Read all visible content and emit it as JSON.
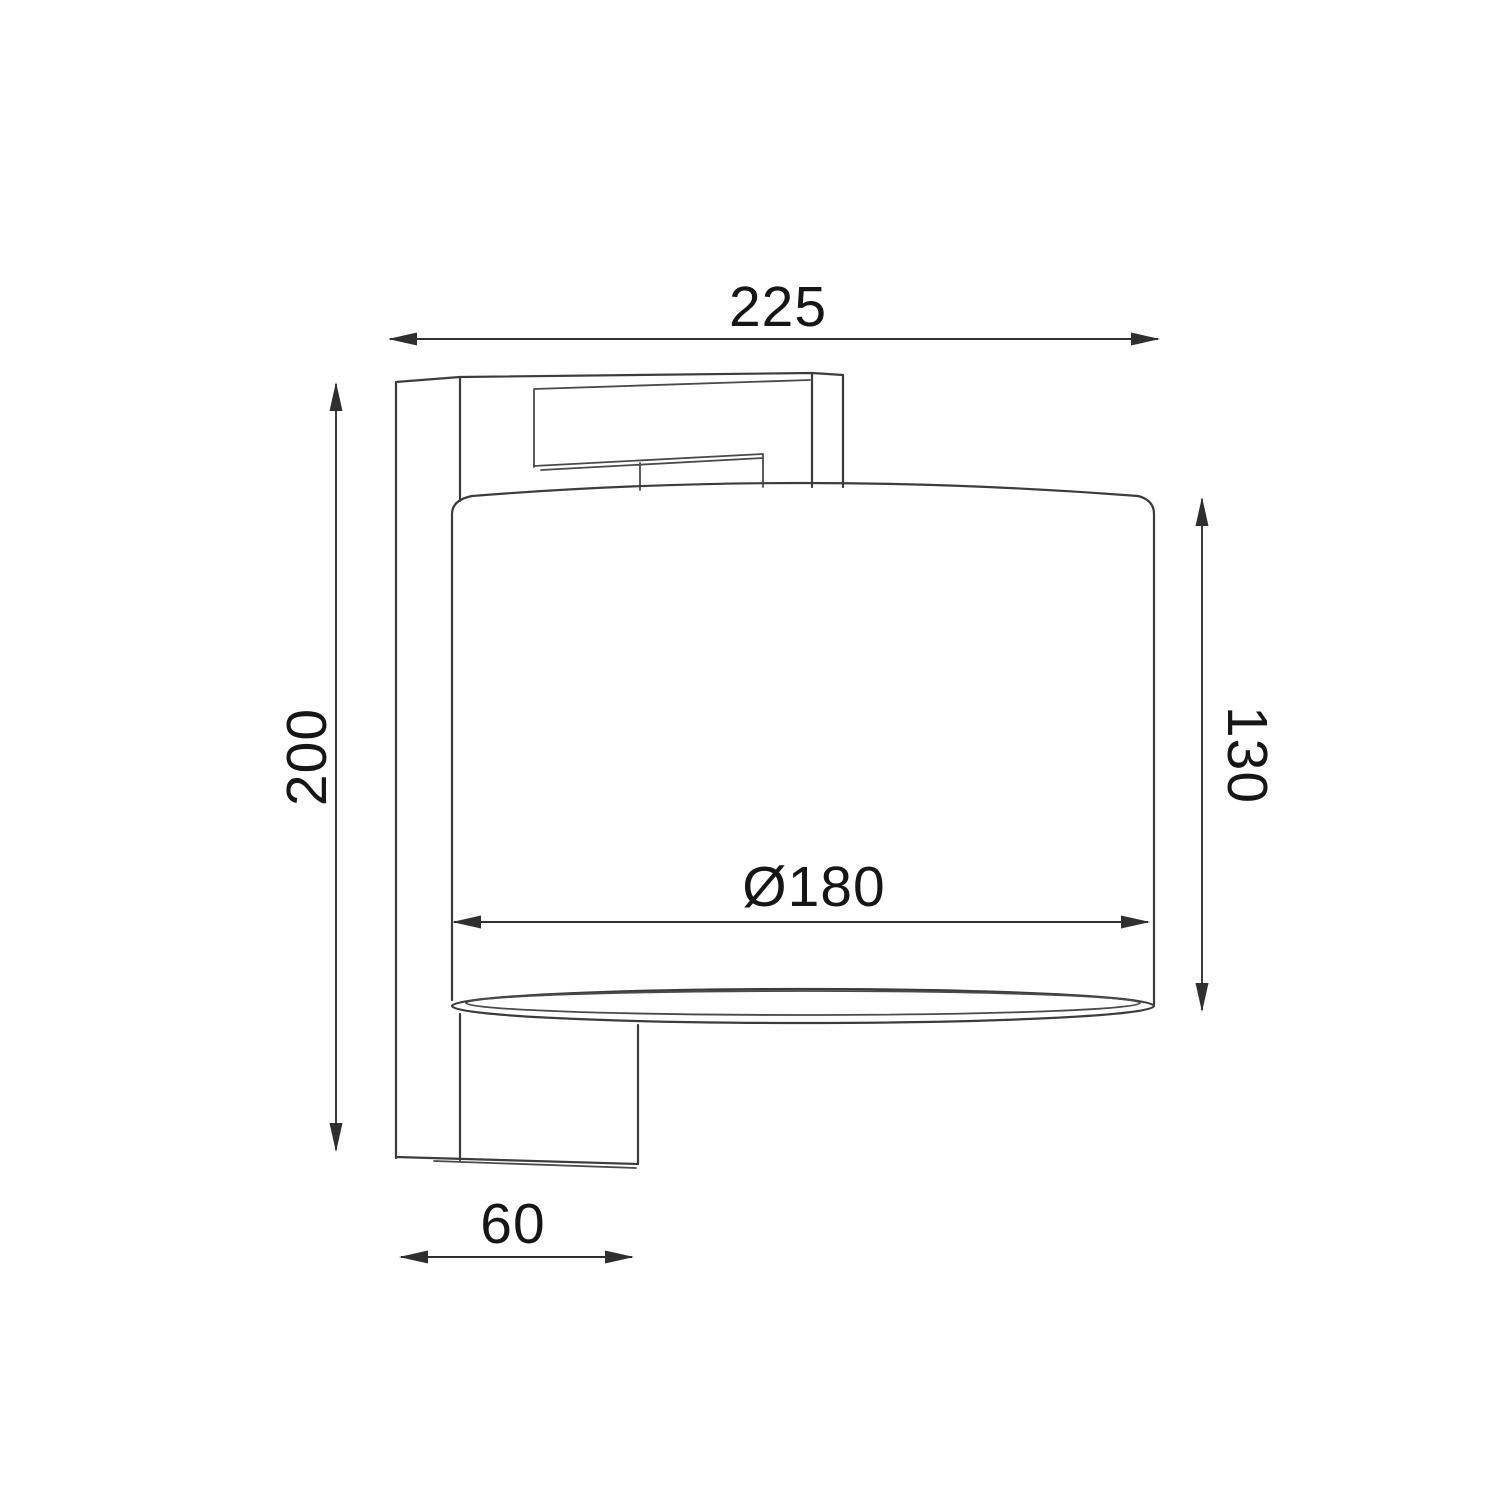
{
  "drawing": {
    "kind": "technical dimension drawing of a wall light, side view",
    "labels": {
      "overall_depth": "225",
      "overall_height": "200",
      "shade_height": "130",
      "shade_diameter": "Ø180",
      "bracket_depth": "60"
    },
    "colors": {
      "outline": "#3c3c3c",
      "dimension": "#2f2f2f",
      "text": "#161616",
      "background": "#ffffff"
    }
  }
}
